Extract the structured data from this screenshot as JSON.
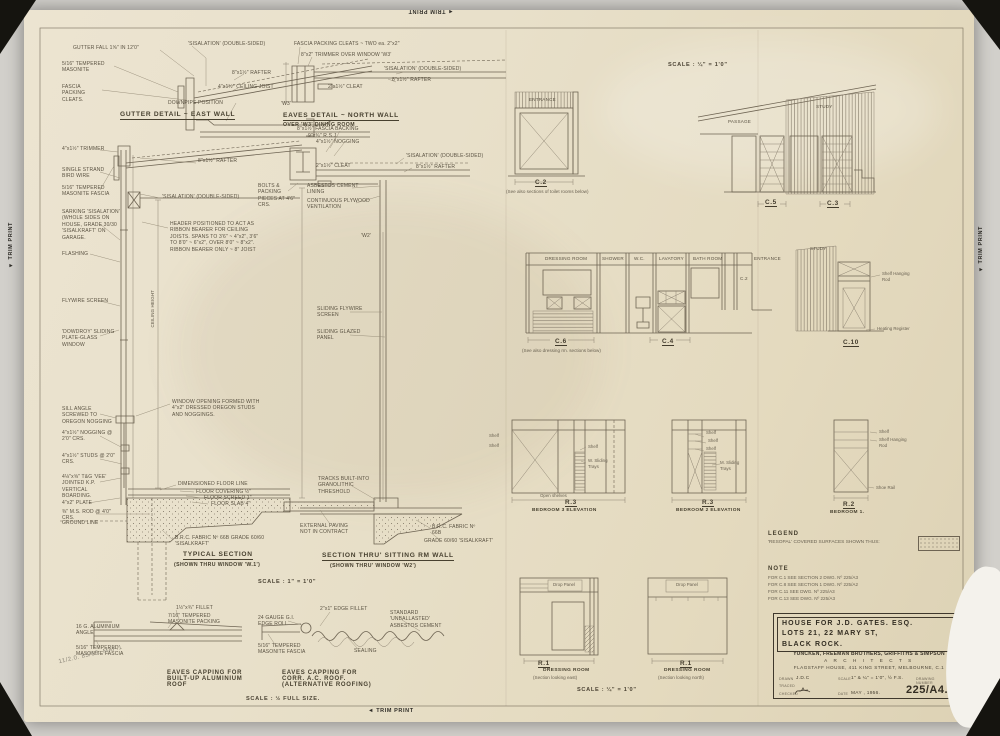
{
  "photo": {
    "trim_print": "TRIM PRINT",
    "trim_arrow": "◄",
    "pencil_note": "11/2.0.  83/66.  MAP.1"
  },
  "gutter": {
    "title": "GUTTER DETAIL ~ EAST WALL",
    "fall": "GUTTER FALL 1⅝\" IN 12'0\"",
    "masonite": "5/16\" TEMPERED MASONITE",
    "cleats": "FASCIA PACKING CLEATS.",
    "sisalation": "'SISALATION' (DOUBLE-SIDED)",
    "rafter": "8\"x1½\" RAFTER",
    "joist": "4\"x1½\" CEILING JOIST",
    "downpipe": "DOWNPIPE POSITION"
  },
  "eaves_north": {
    "title": "EAVES DETAIL ~ NORTH WALL",
    "subtitle": "OVER 'W3' DINING ROOM",
    "cleats": "FASCIA PACKING CLEATS ~ TWO ea. 2\"x2\"",
    "trimmer": "8\"x2\" TRIMMER OVER WINDOW 'W3'",
    "sisalation": "'SISALATION' (DOUBLE-SIDED)",
    "rafter": "8\"x1½\" RAFTER",
    "cleat": "2\"x1½\" CLEAT",
    "w3": "'W3'"
  },
  "typical": {
    "title": "TYPICAL SECTION",
    "subtitle": "(SHOWN THRU WINDOW 'W.1')",
    "scale": "SCALE : 1\" = 1'0\"",
    "trimmer": "4\"x1½\" TRIMMER",
    "bird_wire": "SINGLE STRAND BIRD WIRE",
    "fascia": "5/16\" TEMPERED MASONITE FASCIA",
    "sarking": "SARKING 'SISALATION' (WHOLE SIDES ON HOUSE, GRADE 30/30 'SISALKRAFT' ON GARAGE.",
    "flashing": "FLASHING",
    "flywire": "FLYWIRE SCREEN",
    "window": "'DOWDROY' SLIDING PLATE-GLASS WINDOW",
    "sill": "SILL ANGLE SCREWED TO OREGON NOGGING",
    "nogging": "4\"x1½\" NOGGING @ 2'0\" CRS.",
    "studs": "4\"x1½\" STUDS @ 2'0\" CRS.",
    "boarding": "4⅛\"x⅝\" T&G 'VEE' JOINTED K.P. VERTICAL BOARDING.",
    "plate": "4\"x2\" PLATE",
    "rod": "⅜\" M.S. ROD @ 4'0\" CRS.",
    "ground": "GROUND LINE",
    "rafter": "8\"x1½\" RAFTER",
    "sisalation": "'SISALATION' (DOUBLE-SIDED)",
    "header": "HEADER POSITIONED TO ACT AS RIBBON BEARER FOR CEILING JOISTS. SPANS TO 3'6\" ~ 4\"x2\", 3'6\" TO 8'0\" ~ 6\"x2\", OVER 8'0\" ~ 8\"x2\". RIBBON BEARER ONLY ~ 8\" JOIST",
    "ceiling_height": "CEILING HEIGHT",
    "window_opening": "WINDOW OPENING FORMED WITH 4\"x2\" DRESSED OREGON STUDS AND NOGGINGS.",
    "floor_line": "DIMENSIONED FLOOR LINE",
    "covering": "FLOOR COVERING ½\"",
    "screed": "FLOOR SCREED 1\"",
    "slab": "FLOOR SLAB 4\"",
    "fabric": "B.R.C. FABRIC Nº 66B GRADE 60/60 'SISALKRAFT'"
  },
  "sitting": {
    "title": "SECTION THRU' SITTING RM WALL",
    "subtitle": "(SHOWN THRU' WINDOW 'W2')",
    "fascia_backing": "8\"x1½\" FASCIA BACKING",
    "rsj": "9\"x¾\" R.S.J.",
    "nogging": "4\"x1½\" NOGGING",
    "cleat": "2\"x1½\" CLEAT",
    "bolts": "BOLTS & PACKING PIECES AT 4'6\" CRS.",
    "ac_lining": "ASBESTOS CEMENT LINING",
    "vent": "CONTINUOUS PLYWOOD VENTILATION",
    "sisalation": "'SISALATION' (DOUBLE-SIDED)",
    "rafter": "8\"x1½\" RAFTER",
    "w2": "'W2'",
    "flywire": "SLIDING FLYWIRE SCREEN",
    "glazed": "SLIDING GLAZED PANEL",
    "tracks": "TRACKS BUILT-INTO GRANOLITHIC THRESHOLD",
    "paving": "EXTERNAL PAVING NOT IN CONTRACT",
    "fabric": "B.R.C. FABRIC Nº 66B",
    "grade": "GRADE 60/60 'SISALKRAFT'"
  },
  "elev": {
    "scale_top": "SCALE : ¼\" = 1'0\"",
    "c2": {
      "room": "ENTRANCE",
      "ref": "C.2",
      "note": "(See also sections of toilet rooms below)"
    },
    "c5c3": {
      "passage": "PASSAGE",
      "study": "STUDY",
      "ref1": "C.5",
      "ref2": "C.3"
    },
    "toilets": {
      "rooms": [
        "DRESSING ROOM",
        "SHOWER",
        "W.C.",
        "LAVATORY",
        "BATH ROOM"
      ],
      "c2": "C.2",
      "entrance": "ENTRANCE",
      "ref1": "C.6",
      "note": "(See also dressing rm. sections below)",
      "ref2": "C.4"
    },
    "c10": {
      "room": "STUDY",
      "shelf": "Shelf Hanging Rod",
      "register": "Heating Register",
      "ref": "C.10"
    },
    "bed3": {
      "ref": "R.3",
      "title": "BEDROOM 3 ELEVATION",
      "shelf_l1": "Shelf",
      "shelf_l2": "Shelf",
      "shelf": "Shelf",
      "trays": "W. Sliding Trays",
      "open": "Open shelves"
    },
    "bed2": {
      "ref": "R.3",
      "title": "BEDROOM 2 ELEVATION",
      "shelf1": "Shelf",
      "shelf2": "Shelf",
      "shelf3": "Shelf",
      "trays": "M. Sliding Trays"
    },
    "bed1": {
      "ref": "R.2",
      "title": "BEDROOM 1.",
      "shelf": "Shelf",
      "hanging": "Shelf Hanging Rod",
      "shoe": "Shoe Rail"
    },
    "r1east": {
      "ref": "R.1",
      "title": "DRESSING ROOM",
      "subtitle": "(Section looking east)",
      "drop": "Drop Panel"
    },
    "r1north": {
      "ref": "R.1",
      "title": "DRESSING ROOM",
      "subtitle": "(Section looking north)",
      "drop": "Drop Panel"
    },
    "scale_bottom": "SCALE : ¼\" = 1'0\""
  },
  "capping": {
    "left_title": "EAVES CAPPING FOR BUILT-UP ALUMINIUM ROOF",
    "right_title": "EAVES CAPPING FOR CORR. A.C. ROOF. (ALTERNATIVE ROOFING)",
    "scale": "SCALE : ½ FULL SIZE.",
    "fillet": "1½\"x¾\" FILLET",
    "packing": "7/16\" TEMPERED MASONITE PACKING",
    "angle": "16 G. ALUMINIUM ANGLE",
    "fascia_l": "5/16\" TEMPERED MASONITE FASCIA",
    "edge_roll": "24 GAUGE G.I. EDGE ROLL",
    "edge_fillet": "2\"x1\" EDGE FILLET",
    "ac": "STANDARD 'UNBALLASTED' ASBESTOS CEMENT",
    "sealing": "SEALING",
    "fascia_r": "5/16\" TEMPERED MASONITE FASCIA"
  },
  "legend": {
    "title": "LEGEND",
    "text": "'RESOPAL' COVERED SURFACES SHOWN THUS:"
  },
  "note": {
    "title": "NOTE",
    "lines": [
      "FOR C.1 SEE SECTION 2 DWG. Nº 225/A3",
      "FOR C.8 SEE SECTION 1 DWG. Nº 225/A2",
      "FOR C.11 SEE DWG. Nº 225/A3",
      "FOR C.13 SEE DWG. Nº 225/A3"
    ]
  },
  "title_block": {
    "project": [
      "HOUSE FOR J.D. GATES. ESQ.",
      "LOTS 21, 22 MARY ST,",
      "BLACK ROCK."
    ],
    "firm": "YUNCKEN, FREEMAN BROTHERS, GRIFFITHS & SIMPSON",
    "profession": "A R C H I T E C T S",
    "address": "FLAGSTAFF HOUSE, 411 KING STREET, MELBOURNE, C.1",
    "drawn_label": "DRAWN",
    "drawn": "J.D.C",
    "traced_label": "TRACED",
    "checked_label": "CHECKED",
    "scale_label": "SCALE",
    "scale": "1\" & ¼\" = 1'0\", ½ F.S.",
    "number_label": "DRAWING NUMBER",
    "date_label": "DATE",
    "date": "MAY , 1956.",
    "number": "225/A4."
  }
}
